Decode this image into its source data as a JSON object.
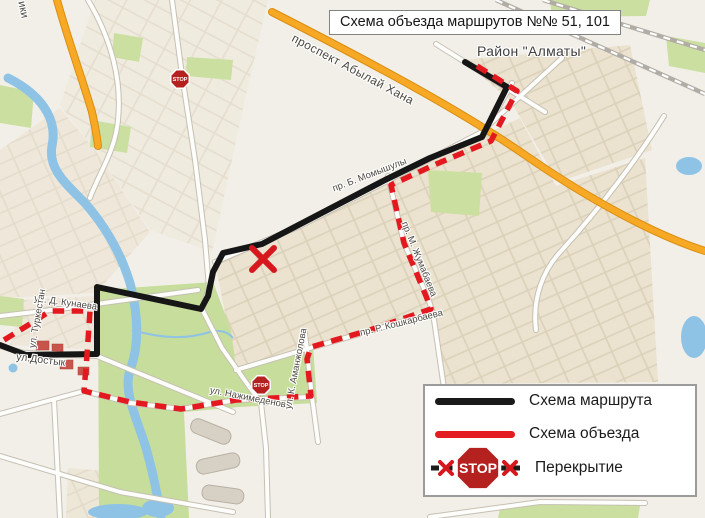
{
  "title": "Схема объезда маршрутов №№ 51, 101",
  "map": {
    "district_label": "Район \"Алматы\"",
    "street_labels": {
      "abylai_khan": "проспект Абылай Хана",
      "momyshuly": "пр. Б. Момышулы",
      "zhumabayev": "пр. М. Жумабаева",
      "koshkarbayev": "пр. Р. Кошкарбаева",
      "kunayev": "ул. Д. Кунаева",
      "turkestan": "ул. Туркестан",
      "dostyk": "ул.Достык",
      "nazhimedenov": "ул. Нажимеденова",
      "amanzholov": "ул. К. Аманжолова",
      "edge_partial": "ики"
    },
    "stop_sign_text": "STOP"
  },
  "legend": {
    "items": [
      {
        "key": "route",
        "label": "Схема маршрута"
      },
      {
        "key": "detour",
        "label": "Схема объезда"
      },
      {
        "key": "closure",
        "label": "Перекрытие"
      }
    ]
  },
  "colors": {
    "route_black": "#161616",
    "detour_red": "#e3191f",
    "stop_sign_red": "#b5211f",
    "road_orange": "#f7a824",
    "water_blue": "#8fc3e6",
    "park_green": "#cbe0a0",
    "map_background": "#f2efe9"
  }
}
